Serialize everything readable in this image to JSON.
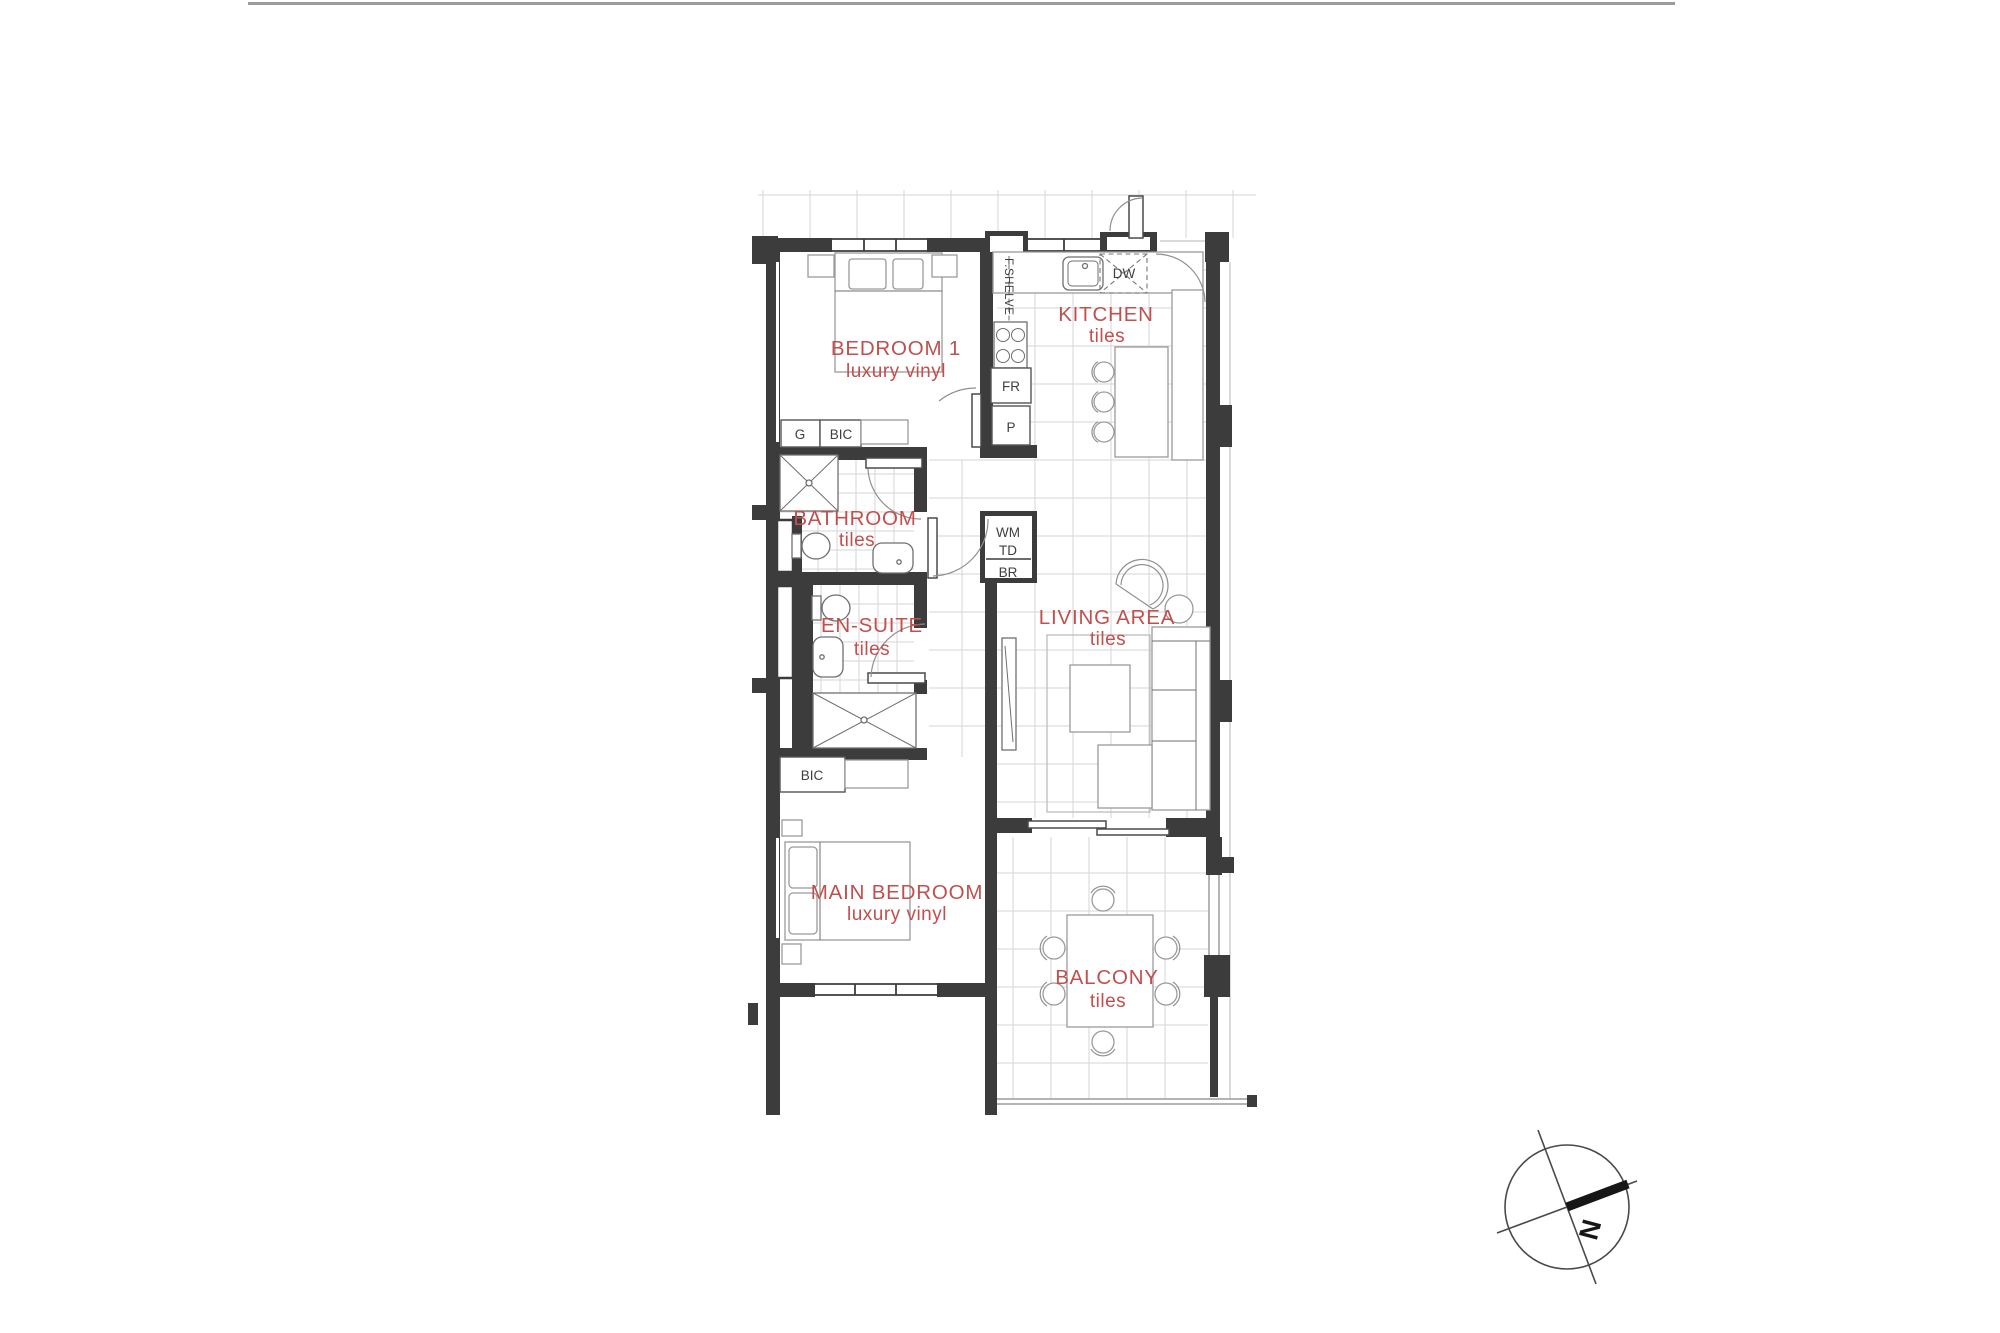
{
  "rooms": {
    "bedroom1": {
      "label": "BEDROOM 1",
      "finish": "luxury vinyl"
    },
    "kitchen": {
      "label": "KITCHEN",
      "finish": "tiles"
    },
    "bathroom": {
      "label": "BATHROOM",
      "finish": "tiles"
    },
    "ensuite": {
      "label": "EN-SUITE",
      "finish": "tiles"
    },
    "living": {
      "label": "LIVING AREA",
      "finish": "tiles"
    },
    "main_bedroom": {
      "label": "MAIN BEDROOM",
      "finish": "luxury vinyl"
    },
    "balcony": {
      "label": "BALCONY",
      "finish": "tiles"
    }
  },
  "fixtures": {
    "g": "G",
    "bic_bedroom1": "BIC",
    "fr": "FR",
    "p": "P",
    "dw": "DW",
    "f_shelve": "F.SHELVE",
    "wm": "WM",
    "td": "TD",
    "br": "BR",
    "bic_main": "BIC"
  },
  "compass": {
    "north": "N"
  },
  "colors": {
    "wall": "#3c3c3c",
    "room_label": "#c0504d",
    "grid": "#d6d6d6",
    "furniture": "#9a9a9a",
    "fixture": "#6f6f6f",
    "arc": "#8f8f8f",
    "rule": "#9c9c9c"
  }
}
